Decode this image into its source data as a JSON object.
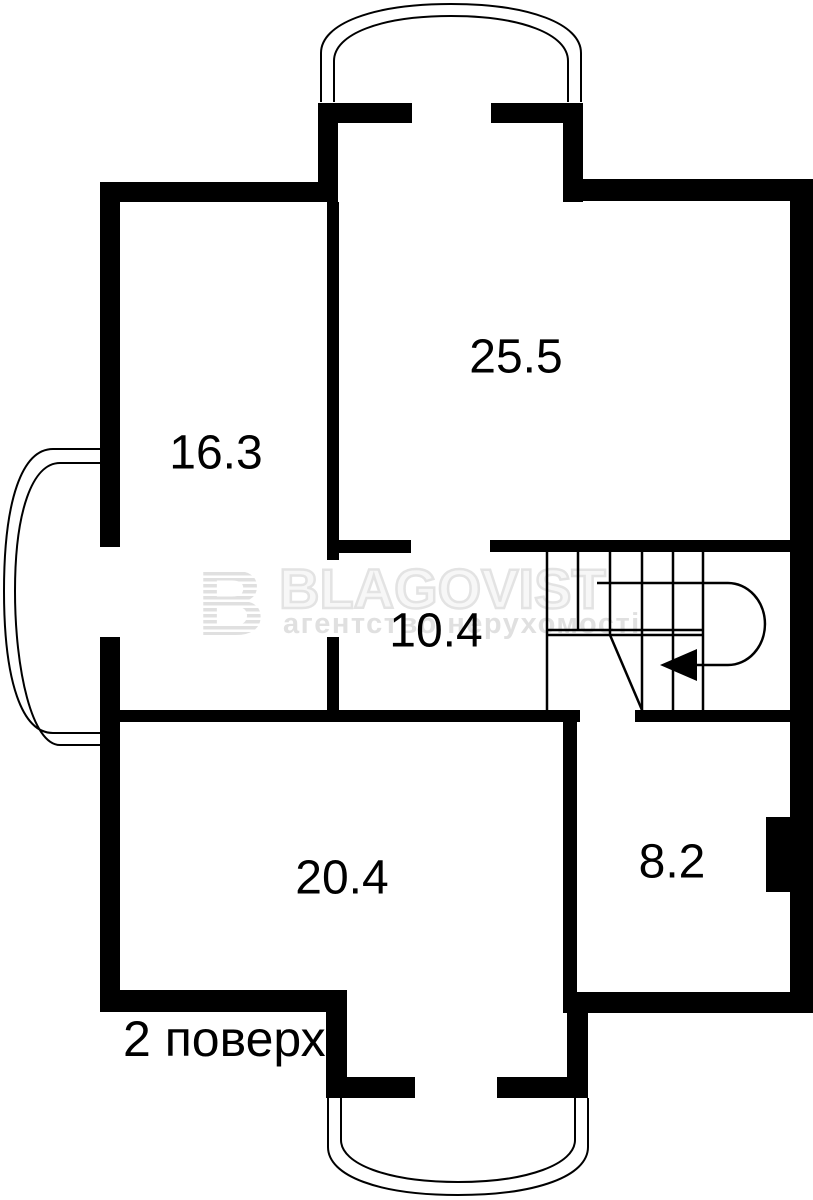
{
  "floor_plan": {
    "floor_label": "2 поверх",
    "rooms": [
      {
        "area_label": "25.5"
      },
      {
        "area_label": "16.3"
      },
      {
        "area_label": "10.4"
      },
      {
        "area_label": "20.4"
      },
      {
        "area_label": "8.2"
      }
    ]
  },
  "watermark": {
    "logo_letter": "B",
    "brand": "BLAGOVIST",
    "tagline": "агентство нерухомості"
  },
  "colors": {
    "wall": "#000000",
    "background": "#ffffff",
    "watermark_light": "#e0e0e0"
  }
}
